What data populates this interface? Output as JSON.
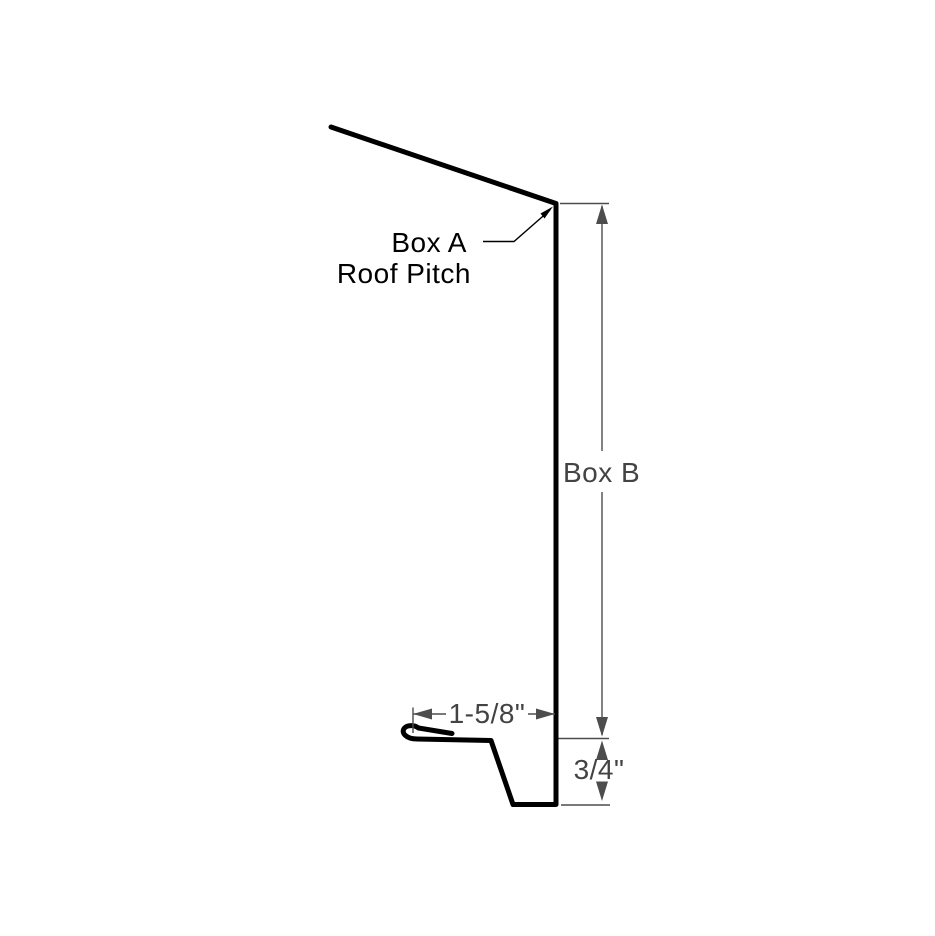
{
  "diagram": {
    "description": "Eave trim profile cross-section with dimension callouts",
    "background_color": "#ffffff",
    "colors": {
      "profile_line": "#000000",
      "callout_line": "#000000",
      "callout_text": "#000000",
      "dimension_line": "#4d4d4d",
      "dimension_text": "#434343"
    },
    "callout_a": {
      "line1": "Box A",
      "line2": "Roof Pitch"
    },
    "dimensions": {
      "box_b": {
        "label": "Box B",
        "orientation": "vertical"
      },
      "hem_width": {
        "label": "1-5/8\"",
        "orientation": "horizontal"
      },
      "kick_height": {
        "label": "3/4\"",
        "orientation": "vertical"
      }
    }
  }
}
